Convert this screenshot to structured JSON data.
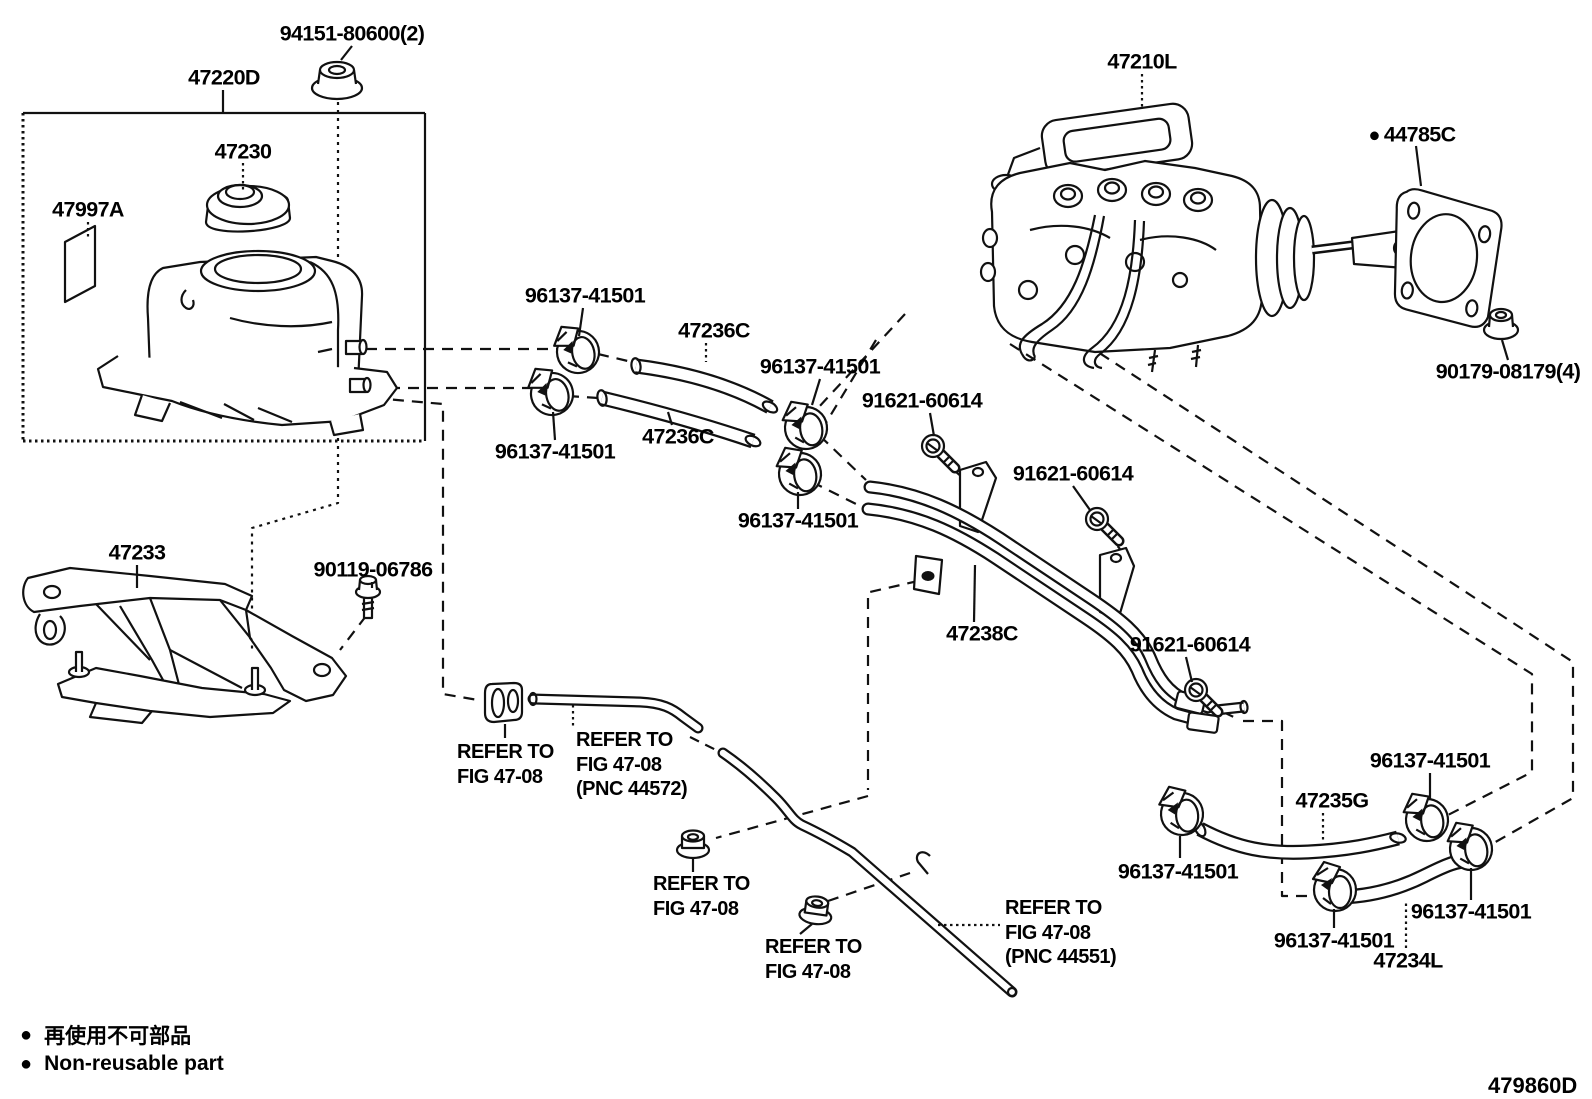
{
  "diagram": {
    "footer_code": "479860D",
    "legend": {
      "marker": "●",
      "jp": "再使用不可部品",
      "en": "Non-reusable part"
    },
    "part_labels": [
      {
        "id": "94151-80600",
        "text": "94151-80600(2)"
      },
      {
        "id": "47220D",
        "text": "47220D"
      },
      {
        "id": "47230",
        "text": "47230"
      },
      {
        "id": "47997A",
        "text": "47997A"
      },
      {
        "id": "47210L",
        "text": "47210L"
      },
      {
        "id": "44785C",
        "text": "44785C",
        "non_reusable": true
      },
      {
        "id": "96137-41501-a",
        "text": "96137-41501"
      },
      {
        "id": "47236C-a",
        "text": "47236C"
      },
      {
        "id": "96137-41501-b",
        "text": "96137-41501"
      },
      {
        "id": "91621-60614-a",
        "text": "91621-60614"
      },
      {
        "id": "96137-41501-c",
        "text": "96137-41501"
      },
      {
        "id": "47236C-b",
        "text": "47236C"
      },
      {
        "id": "91621-60614-b",
        "text": "91621-60614"
      },
      {
        "id": "96137-41501-d",
        "text": "96137-41501"
      },
      {
        "id": "90179-08179",
        "text": "90179-08179(4)"
      },
      {
        "id": "47233",
        "text": "47233"
      },
      {
        "id": "90119-06786",
        "text": "90119-06786"
      },
      {
        "id": "47238C",
        "text": "47238C"
      },
      {
        "id": "91621-60614-c",
        "text": "91621-60614"
      },
      {
        "id": "96137-41501-e",
        "text": "96137-41501"
      },
      {
        "id": "47235G",
        "text": "47235G"
      },
      {
        "id": "96137-41501-f",
        "text": "96137-41501"
      },
      {
        "id": "96137-41501-g",
        "text": "96137-41501"
      },
      {
        "id": "96137-41501-h",
        "text": "96137-41501"
      },
      {
        "id": "47234L",
        "text": "47234L"
      }
    ],
    "refer_notes": [
      {
        "lines": [
          "REFER TO",
          "FIG 47-08"
        ]
      },
      {
        "lines": [
          "REFER TO",
          "FIG 47-08",
          "(PNC 44572)"
        ]
      },
      {
        "lines": [
          "REFER TO",
          "FIG 47-08"
        ]
      },
      {
        "lines": [
          "REFER TO",
          "FIG 47-08"
        ]
      },
      {
        "lines": [
          "REFER TO",
          "FIG 47-08",
          "(PNC 44551)"
        ]
      }
    ]
  }
}
